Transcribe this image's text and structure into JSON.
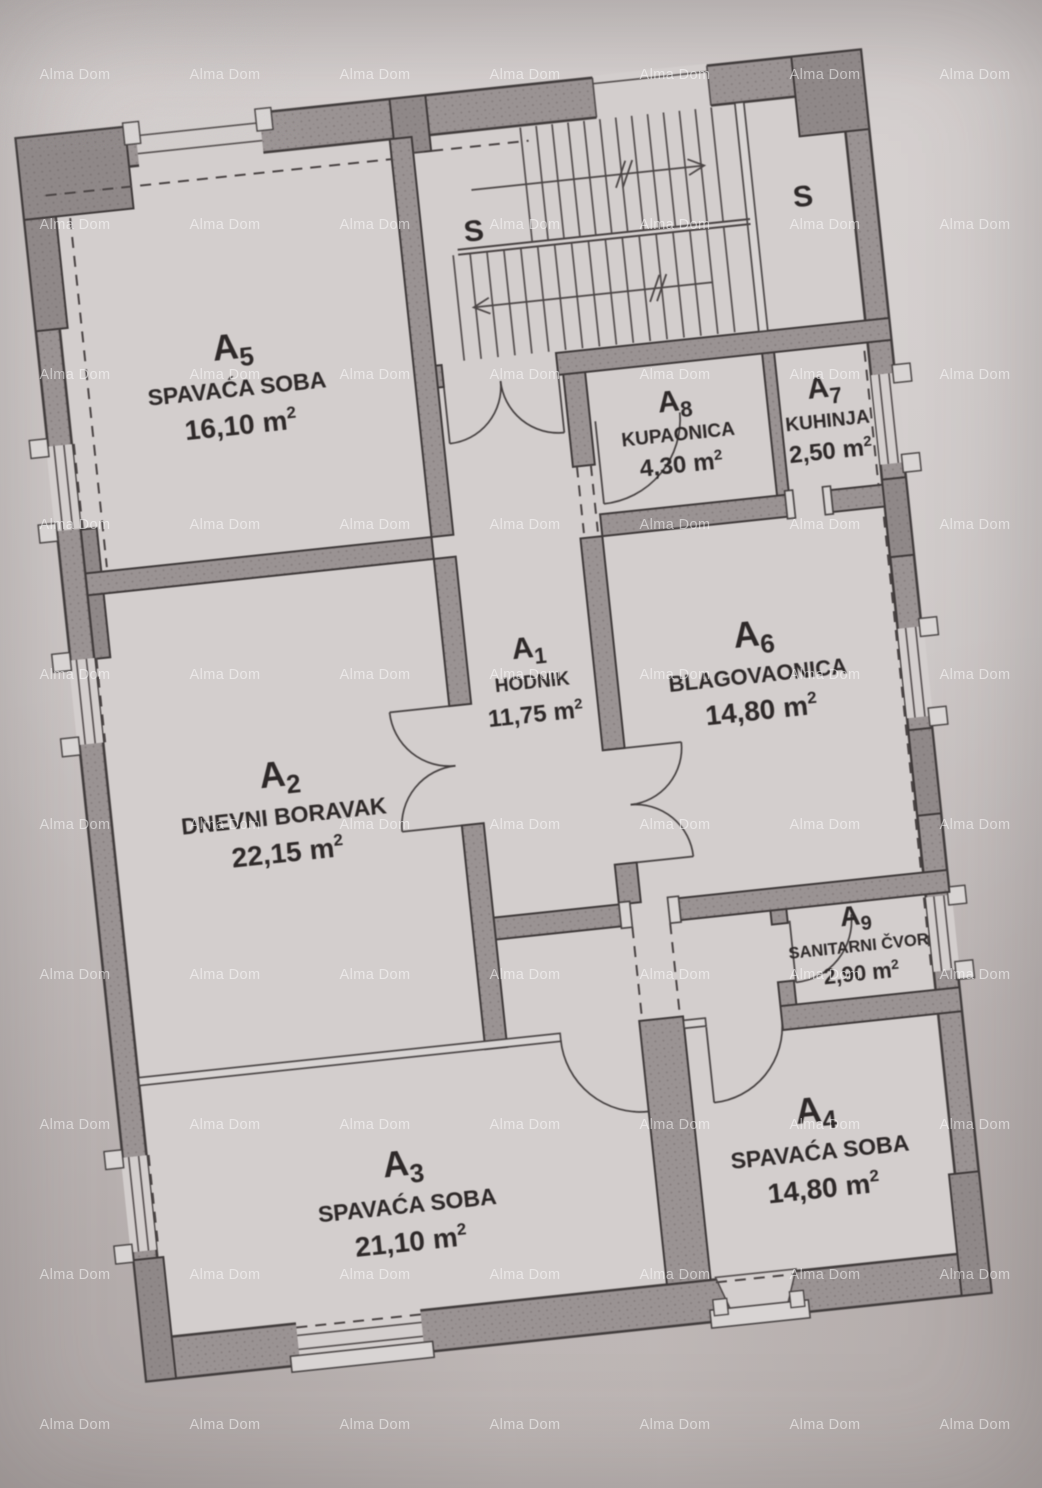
{
  "watermark": {
    "text": "Alma Dom"
  },
  "stairwell": {
    "left_label": "S",
    "right_label": "S"
  },
  "rooms": [
    {
      "id": "A",
      "sub": "1",
      "name": "HODNIK",
      "area": "11,75",
      "unit": "m",
      "sup": "2"
    },
    {
      "id": "A",
      "sub": "2",
      "name": "DNEVNI BORAVAK",
      "area": "22,15",
      "unit": "m",
      "sup": "2"
    },
    {
      "id": "A",
      "sub": "3",
      "name": "SPAVAĆA SOBA",
      "area": "21,10",
      "unit": "m",
      "sup": "2"
    },
    {
      "id": "A",
      "sub": "4",
      "name": "SPAVAĆA SOBA",
      "area": "14,80",
      "unit": "m",
      "sup": "2"
    },
    {
      "id": "A",
      "sub": "5",
      "name": "SPAVAĆA SOBA",
      "area": "16,10",
      "unit": "m",
      "sup": "2"
    },
    {
      "id": "A",
      "sub": "6",
      "name": "BLAGOVAONICA",
      "area": "14,80",
      "unit": "m",
      "sup": "2"
    },
    {
      "id": "A",
      "sub": "7",
      "name": "KUHINJA",
      "area": "2,50",
      "unit": "m",
      "sup": "2"
    },
    {
      "id": "A",
      "sub": "8",
      "name": "KUPAONICA",
      "area": "4,30",
      "unit": "m",
      "sup": "2"
    },
    {
      "id": "A",
      "sub": "9",
      "name": "SANITARNI ČVOR",
      "area": "2,90",
      "unit": "m",
      "sup": "2"
    }
  ],
  "colors": {
    "paper": "#cbc5c4",
    "floor": "#d3cecd",
    "wall": "#9a9393",
    "wall_dark": "#8f8888",
    "line": "#3f3a3a",
    "watermark": "rgba(255,255,255,0.52)"
  }
}
